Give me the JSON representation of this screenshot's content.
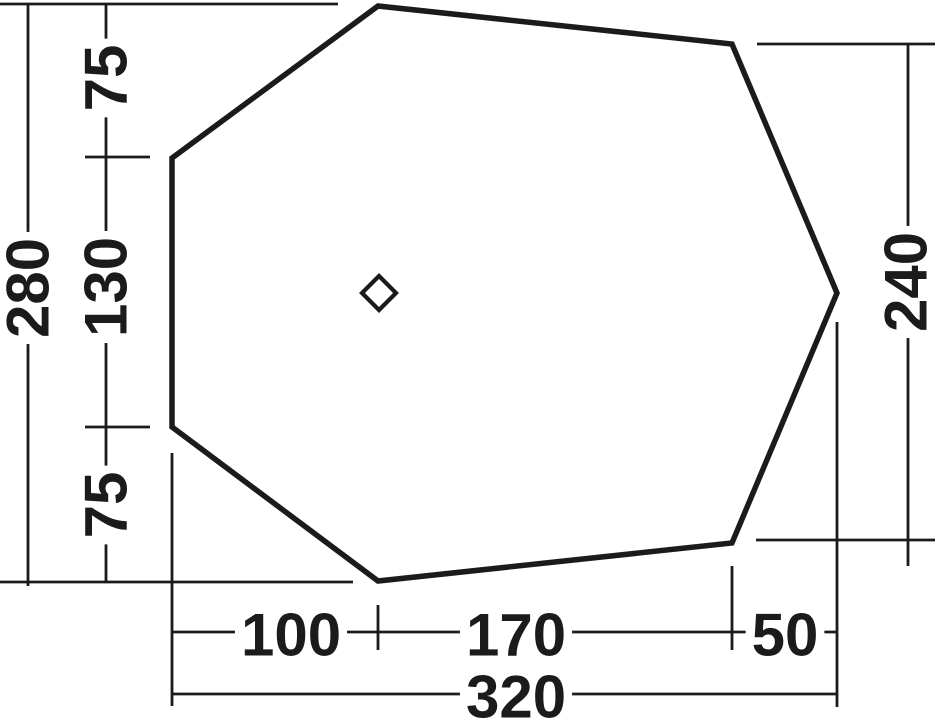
{
  "drawing_title": "tent-footprint-dimension-diagram",
  "canvas": {
    "width": 936,
    "height": 720,
    "background": "#ffffff",
    "ink": "#1b1b1b"
  },
  "shape": {
    "name": "footprint-outline",
    "points": "378,6 732,44 837,293 732,543 378,581 172,427 172,158",
    "stroke_width": 5.5
  },
  "marker": {
    "name": "center-diamond",
    "cx": 379,
    "cy": 293,
    "half": 17,
    "stroke_width": 4.2
  },
  "line_style": {
    "stroke_width": 2.8
  },
  "lines": [
    {
      "name": "extension-top-left",
      "x1": 0,
      "y1": 4,
      "x2": 338,
      "y2": 4
    },
    {
      "name": "extension-bottom-left",
      "x1": 0,
      "y1": 582,
      "x2": 353,
      "y2": 582
    },
    {
      "name": "dimension-line-280",
      "x1": 28,
      "y1": 4,
      "x2": 28,
      "y2": 586
    },
    {
      "name": "dimension-line-left-75-130-75",
      "x1": 106,
      "y1": 4,
      "x2": 106,
      "y2": 583
    },
    {
      "name": "tick-left-upper",
      "x1": 85,
      "y1": 157,
      "x2": 150,
      "y2": 157
    },
    {
      "name": "tick-left-lower",
      "x1": 85,
      "y1": 427,
      "x2": 150,
      "y2": 427
    },
    {
      "name": "extension-right-top",
      "x1": 757,
      "y1": 44,
      "x2": 935,
      "y2": 44
    },
    {
      "name": "extension-right-bottom",
      "x1": 756,
      "y1": 540,
      "x2": 935,
      "y2": 540
    },
    {
      "name": "dimension-line-240",
      "x1": 908,
      "y1": 44,
      "x2": 908,
      "y2": 566
    },
    {
      "name": "extension-bottom-x172",
      "x1": 172,
      "y1": 453,
      "x2": 172,
      "y2": 706
    },
    {
      "name": "extension-bottom-x837",
      "x1": 837,
      "y1": 322,
      "x2": 837,
      "y2": 707
    },
    {
      "name": "tick-bottom-x378",
      "x1": 378,
      "y1": 605,
      "x2": 378,
      "y2": 650
    },
    {
      "name": "tick-bottom-x732",
      "x1": 732,
      "y1": 566,
      "x2": 732,
      "y2": 650
    },
    {
      "name": "dimension-line-100-170-50",
      "x1": 172,
      "y1": 632,
      "x2": 837,
      "y2": 632
    },
    {
      "name": "dimension-line-320",
      "x1": 172,
      "y1": 694,
      "x2": 837,
      "y2": 694
    }
  ],
  "labels": [
    {
      "name": "dim-label-75-top",
      "text": "75",
      "x": 106,
      "y": 78,
      "rotate": true
    },
    {
      "name": "dim-label-130",
      "text": "130",
      "x": 106,
      "y": 287,
      "rotate": true
    },
    {
      "name": "dim-label-75-bottom",
      "text": "75",
      "x": 106,
      "y": 505,
      "rotate": true
    },
    {
      "name": "dim-label-280",
      "text": "280",
      "x": 28,
      "y": 288,
      "rotate": true
    },
    {
      "name": "dim-label-240",
      "text": "240",
      "x": 906,
      "y": 282,
      "rotate": true
    },
    {
      "name": "dim-label-100",
      "text": "100",
      "x": 291,
      "y": 635,
      "rotate": false
    },
    {
      "name": "dim-label-170",
      "text": "170",
      "x": 516,
      "y": 635,
      "rotate": false
    },
    {
      "name": "dim-label-50",
      "text": "50",
      "x": 785,
      "y": 635,
      "rotate": false
    },
    {
      "name": "dim-label-320",
      "text": "320",
      "x": 516,
      "y": 697,
      "rotate": false
    }
  ]
}
